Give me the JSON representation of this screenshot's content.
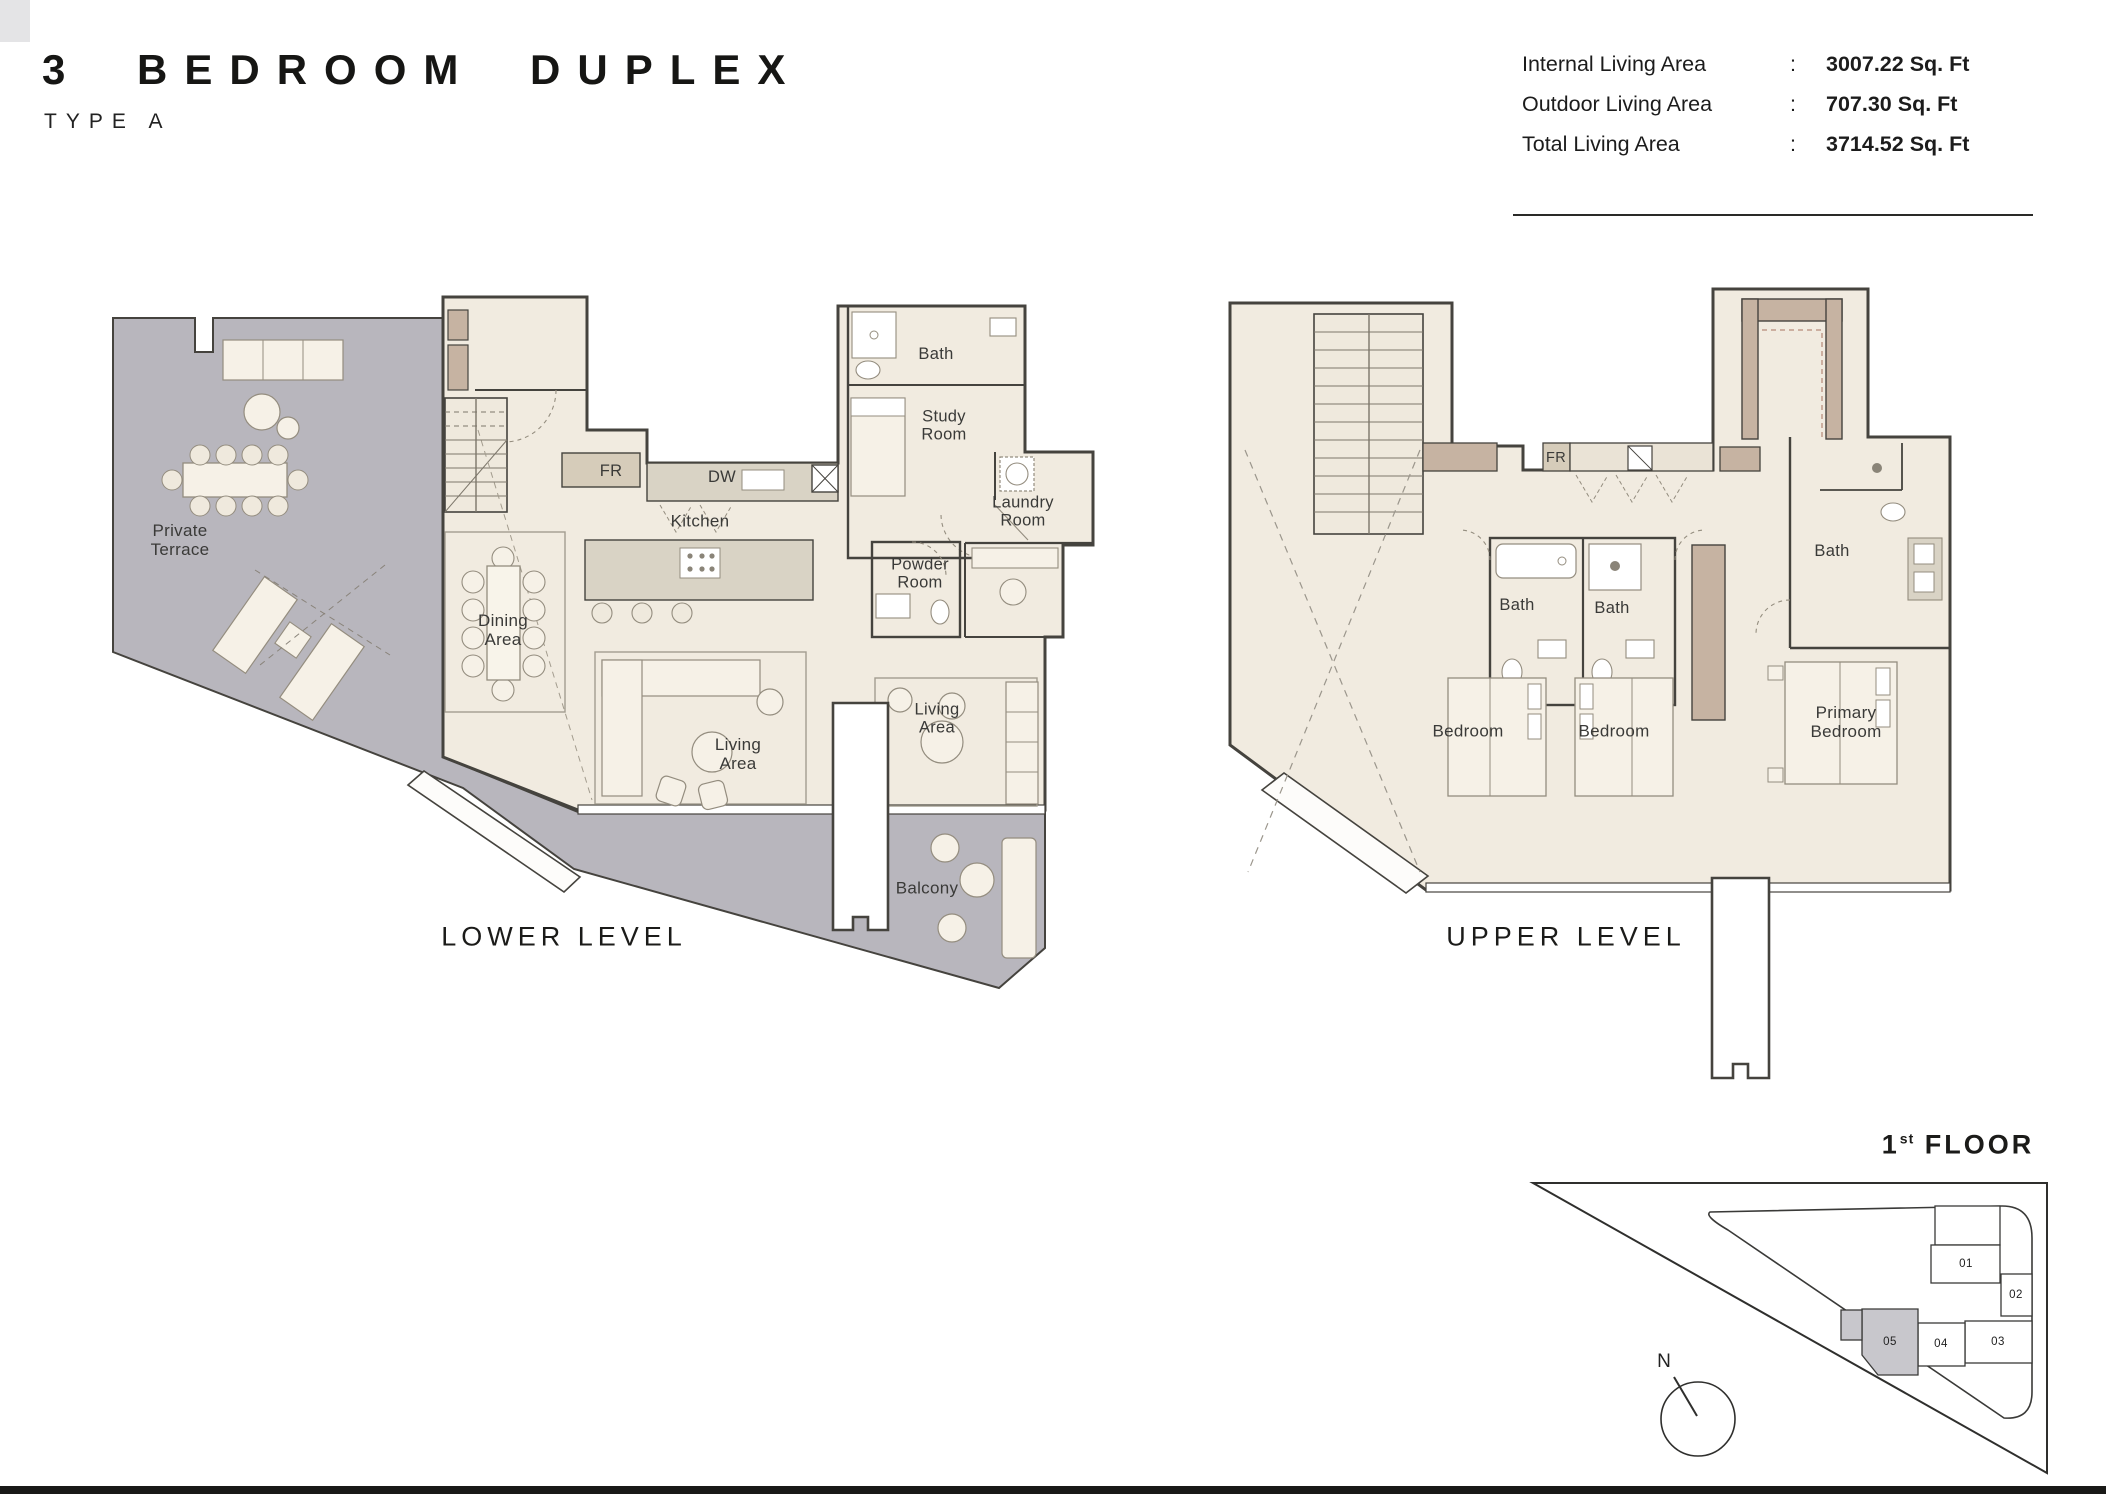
{
  "header": {
    "title": "3 BEDROOM DUPLEX",
    "subtitle": "TYPE A"
  },
  "areas": {
    "rows": [
      {
        "label": "Internal Living Area",
        "colon": ":",
        "value": "3007.22 Sq. Ft"
      },
      {
        "label": "Outdoor Living Area",
        "colon": ":",
        "value": "707.30 Sq. Ft"
      },
      {
        "label": "Total Living Area",
        "colon": ":",
        "value": "3714.52 Sq. Ft"
      }
    ]
  },
  "lower_plan": {
    "caption": "LOWER LEVEL",
    "labels": {
      "private_terrace": [
        "Private",
        "Terrace"
      ],
      "fr": "FR",
      "dw": "DW",
      "kitchen": "Kitchen",
      "dining": [
        "Dining",
        "Area"
      ],
      "living_main": [
        "Living",
        "Area"
      ],
      "living_second": [
        "Living",
        "Area"
      ],
      "bath": "Bath",
      "study": [
        "Study",
        "Room"
      ],
      "laundry": [
        "Laundry",
        "Room"
      ],
      "powder": [
        "Powder",
        "Room"
      ],
      "balcony": "Balcony"
    }
  },
  "upper_plan": {
    "caption": "UPPER LEVEL",
    "labels": {
      "fr": "FR",
      "bath_left": "Bath",
      "bath_mid": "Bath",
      "bath_primary": "Bath",
      "bedroom_left": "Bedroom",
      "bedroom_mid": "Bedroom",
      "primary_bedroom": [
        "Primary",
        "Bedroom"
      ]
    }
  },
  "site_plan": {
    "floor_num": "1",
    "floor_sup": "st",
    "floor_word": "FLOOR",
    "north": "N",
    "units": [
      "01",
      "02",
      "03",
      "04",
      "05"
    ],
    "highlighted_unit": "05"
  },
  "colors": {
    "floor": "#f1ebe0",
    "terrace": "#b8b6bd",
    "taupe": "#c6b3a2",
    "counter": "#d9d3c5",
    "wall": "#45433e",
    "text": "#3a3a38",
    "site_highlight": "#c8c7cc"
  }
}
